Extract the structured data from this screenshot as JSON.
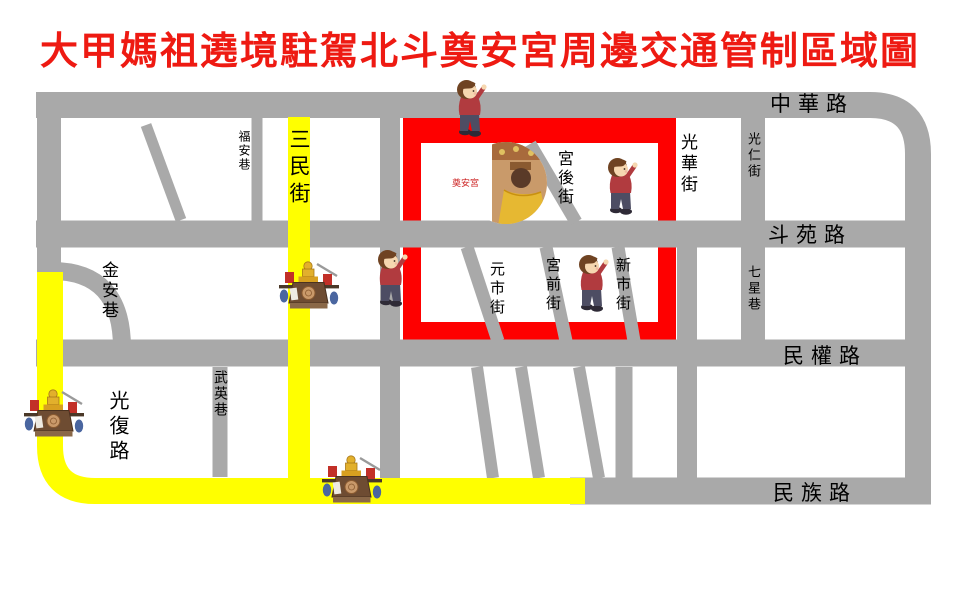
{
  "title": "大甲媽祖遶境駐駕北斗奠安宮周邊交通管制區域圖",
  "colors": {
    "title_red": "#ee1a12",
    "road_gray": "#a9a9a9",
    "pilgrimage_route_yellow": "#ffff00",
    "traffic_control_zone_red": "#fe0000",
    "street_label_black": "#000000"
  },
  "streets": {
    "zhonghua_rd": "中華路",
    "douyuan_rd": "斗苑路",
    "minquan_rd": "民權路",
    "minzu_rd": "民族路",
    "guangfu_rd": "光復路",
    "sanmin_st": "三民街",
    "fuan_ln": "福安巷",
    "jinan_ln": "金安巷",
    "wuying_ln": "武英巷",
    "guanghua_st": "光華街",
    "guangren_ln": "光仁街",
    "qixing_ln": "七星巷",
    "gonghou_st": "宮後街",
    "yuanshi_st": "元市街",
    "gongqian_st": "宮前街",
    "xinshi_st": "新市街"
  },
  "temple": {
    "seal_text": "奠安宮"
  },
  "icons": {
    "person": "saluting-pilgrim-icon",
    "palanquin": "mazu-palanquin-icon",
    "temple_photo": "dianan-temple-photo"
  }
}
